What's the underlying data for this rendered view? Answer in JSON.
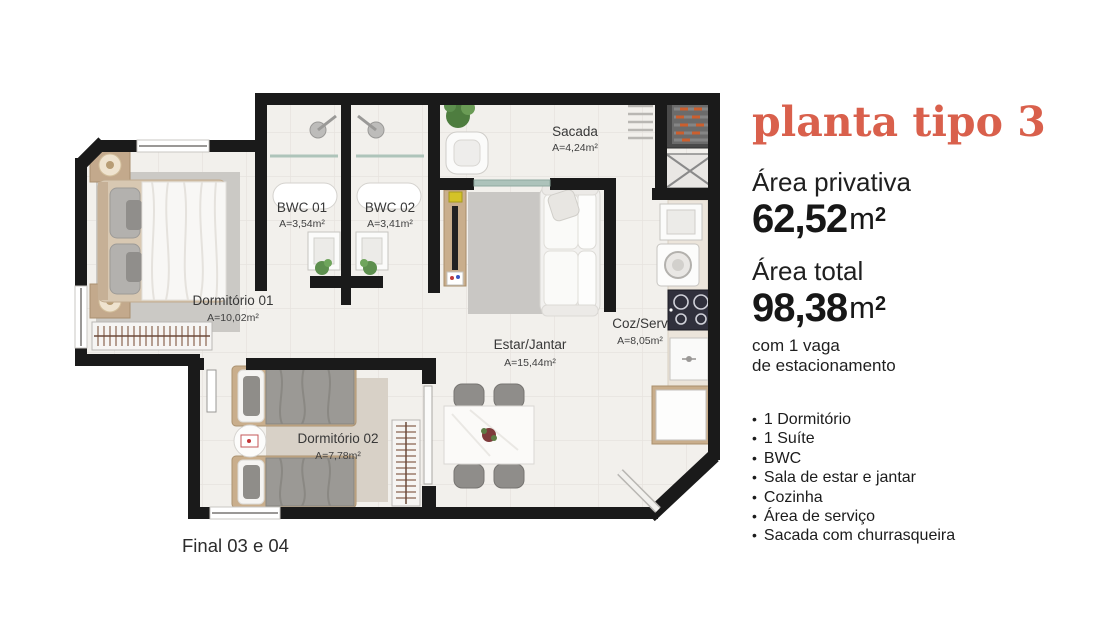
{
  "panel": {
    "title": "planta tipo 3",
    "private_area": {
      "label": "Área privativa",
      "number": "62,52",
      "unit": "m",
      "exp": "2"
    },
    "total_area": {
      "label": "Área total",
      "number": "98,38",
      "unit": "m",
      "exp": "2",
      "note1": "com 1 vaga",
      "note2": "de estacionamento"
    },
    "features": [
      "1 Dormitório",
      "1 Suíte",
      "BWC",
      "Sala de estar e jantar",
      "Cozinha",
      "Área de serviço",
      "Sacada com churrasqueira"
    ]
  },
  "plan": {
    "footer": "Final 03 e 04",
    "rooms": [
      {
        "name": "Sacada",
        "area": "A=4,24m²"
      },
      {
        "name": "BWC 01",
        "area": "A=3,54m²"
      },
      {
        "name": "BWC 02",
        "area": "A=3,41m²"
      },
      {
        "name": "Dormitório 01",
        "area": "A=10,02m²"
      },
      {
        "name": "Dormitório 02",
        "area": "A=7,78m²"
      },
      {
        "name": "Estar/Jantar",
        "area": "A=15,44m²"
      },
      {
        "name": "Coz/Serv",
        "area": "A=8,05m²"
      }
    ]
  },
  "colors": {
    "accent": "#d9604c",
    "wall": "#1a1a1a",
    "floor": "#f2f0ec",
    "text": "#232323"
  }
}
